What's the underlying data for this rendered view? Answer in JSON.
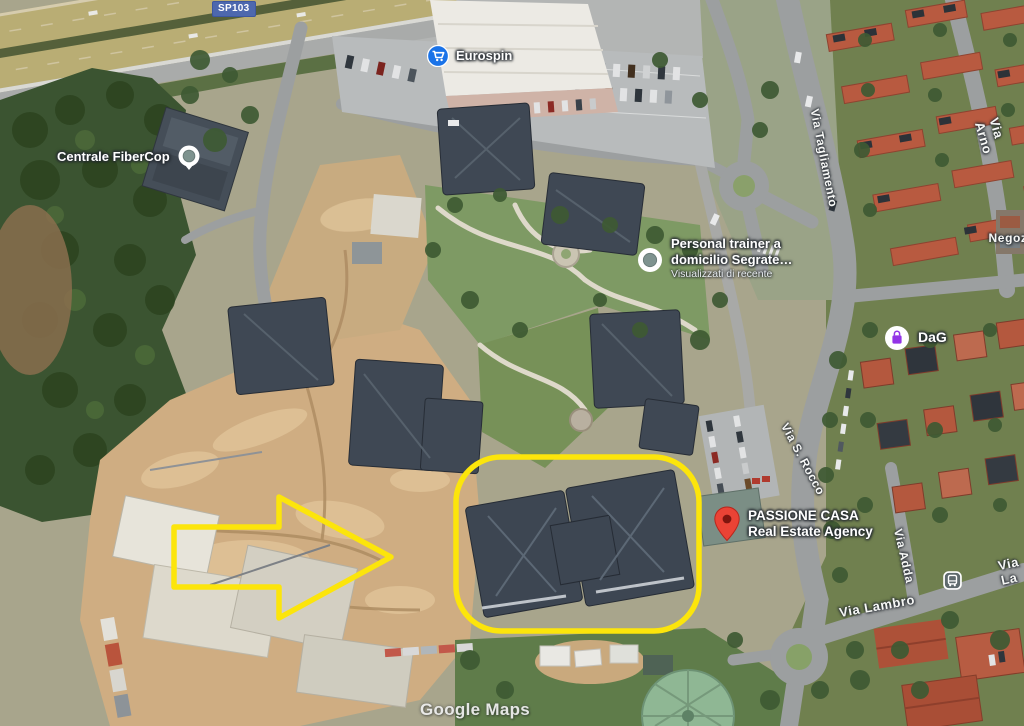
{
  "map": {
    "type": "satellite",
    "attribution": "Google Maps",
    "route_badge": {
      "label": "SP103",
      "color": "#4d68ae"
    },
    "pois": {
      "eurospin": {
        "label": "Eurospin",
        "icon": "shopping-cart-icon",
        "icon_color": "#1a73e8"
      },
      "fibercop": {
        "label": "Centrale FiberCop",
        "icon": "recent-place-icon",
        "icon_color": "#7e938f"
      },
      "trainer": {
        "line1": "Personal trainer a",
        "line2": "domicilio Segrate…",
        "meta": "Visualizzati di recente",
        "icon": "recent-place-icon",
        "icon_color": "#7e938f"
      },
      "dag": {
        "label": "DaG",
        "icon": "shopping-bag-icon",
        "icon_color": "#9334e6"
      },
      "passione": {
        "line1": "PASSIONE CASA",
        "line2": "Real Estate Agency",
        "icon": "red-map-pin-icon",
        "icon_color": "#ea4335"
      }
    },
    "streets": {
      "tagliamento": "Via Tagliamento",
      "arno": "Via Arno",
      "negozi": "Negozi",
      "srocco": "Via S. Rocco",
      "adda": "Via Adda",
      "lambro": "Via Lambro",
      "lambro_east": "Via La",
      "label_color": "#f6f7f5"
    },
    "transit_stop": {
      "icon": "bus-stop-icon"
    },
    "annotations": {
      "color": "#fce50b",
      "shapes": [
        "highlight-arrow",
        "highlight-box"
      ]
    }
  }
}
